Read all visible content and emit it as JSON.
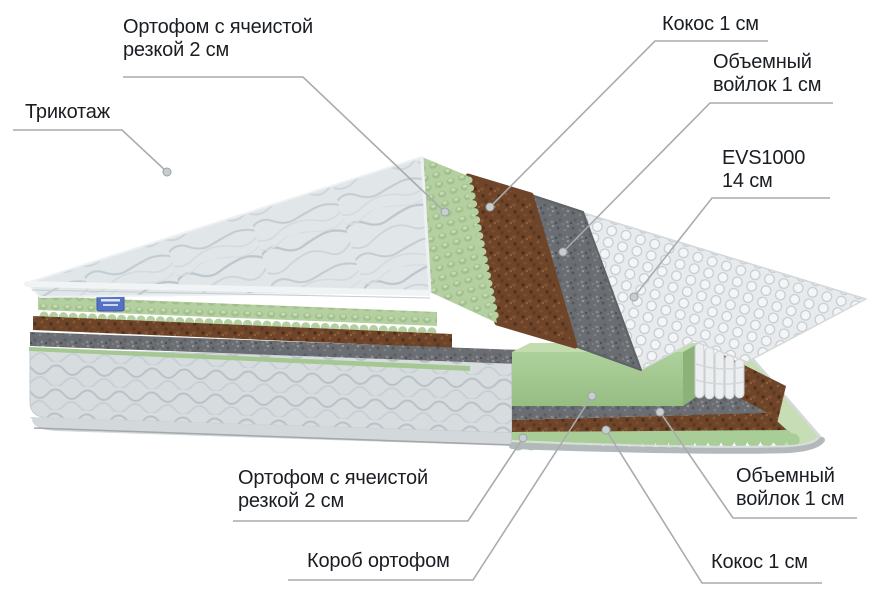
{
  "page": {
    "background": "#ffffff",
    "width": 874,
    "height": 599
  },
  "diagram": {
    "kind": "mattress-layer-callout-diagram",
    "callouts": [
      {
        "key": "orthofoam-top",
        "lines": [
          "Ортофом с ячеистой",
          "резкой 2 см"
        ]
      },
      {
        "key": "knit-fabric",
        "lines": [
          "Трикотаж"
        ]
      },
      {
        "key": "coconut-top",
        "lines": [
          "Кокос 1 см"
        ]
      },
      {
        "key": "felt-top",
        "lines": [
          "Объемный",
          "войлок 1 см"
        ]
      },
      {
        "key": "spring-block",
        "lines": [
          "EVS1000",
          "14 см"
        ]
      },
      {
        "key": "orthofoam-bottom",
        "lines": [
          "Ортофом с ячеистой",
          "резкой 2 см"
        ]
      },
      {
        "key": "foam-box",
        "lines": [
          "Короб ортофом"
        ]
      },
      {
        "key": "felt-bottom",
        "lines": [
          "Объемный",
          "войлок 1 см"
        ]
      },
      {
        "key": "coconut-bottom",
        "lines": [
          "Кокос 1 см"
        ]
      }
    ],
    "colors": {
      "label_text": "#1a1e23",
      "leader_line": "#a7acaf",
      "leader_dot": "#c8cdd0",
      "knit_fabric": "#e1e6e9",
      "foam_green": "#b4cfa0",
      "coconut_brown": "#6f452a",
      "felt_gray": "#6a6d71",
      "springs_white": "#e8ebed",
      "box_fabric": "#d7dcdf",
      "base_rim": "#b2b8bb",
      "tag_blue": "#5471c6"
    }
  }
}
